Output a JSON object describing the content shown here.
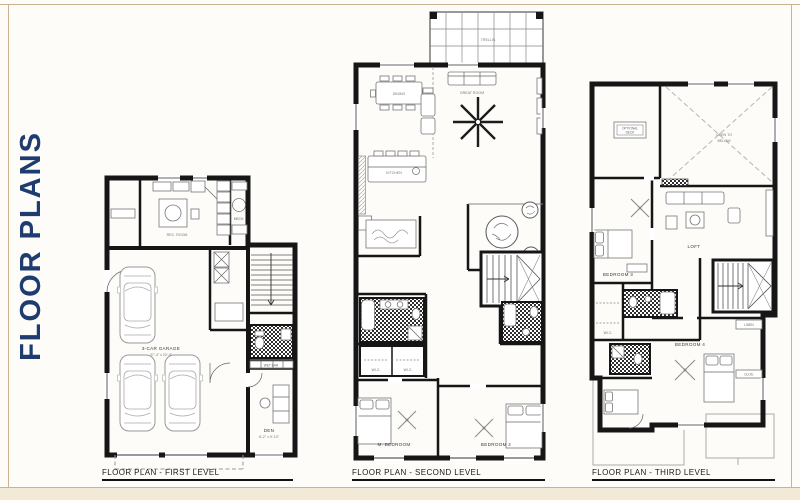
{
  "page": {
    "background": "#fdfcf8",
    "border_color": "#cbb28e",
    "bottom_band_color": "#f2e9d7"
  },
  "title": {
    "text": "FLOOR PLANS",
    "color": "#1e3c6f"
  },
  "plans": [
    {
      "caption": "FLOOR PLAN - FIRST LEVEL",
      "labels": {
        "rec": "REC. ROOM",
        "garage": "3-CAR GARAGE",
        "garage_dim": "37'-4\" x 20'-8\"",
        "den": "DEN",
        "den_dim": "8'-2\" x 9'-10\"",
        "wetbar": "WET BAR",
        "mech": "MECH."
      }
    },
    {
      "caption": "FLOOR PLAN - SECOND LEVEL",
      "labels": {
        "deck": "TRELLIS",
        "dining": "DINING",
        "living": "GREAT ROOM",
        "kitchen": "KITCHEN",
        "mbed": "M. BEDROOM",
        "bed2": "BEDROOM 2",
        "wic": "W.I.C."
      }
    },
    {
      "caption": "FLOOR PLAN - THIRD LEVEL",
      "labels": {
        "open1": "OPEN TO",
        "open2": "BELOW",
        "optional1": "OPTIONAL",
        "optional2": "DECK",
        "loft": "LOFT",
        "bed3": "BEDROOM 3",
        "bed4": "BEDROOM 4",
        "wic": "W.I.C.",
        "linen": "LINEN",
        "closet": "CLOS."
      }
    }
  ]
}
